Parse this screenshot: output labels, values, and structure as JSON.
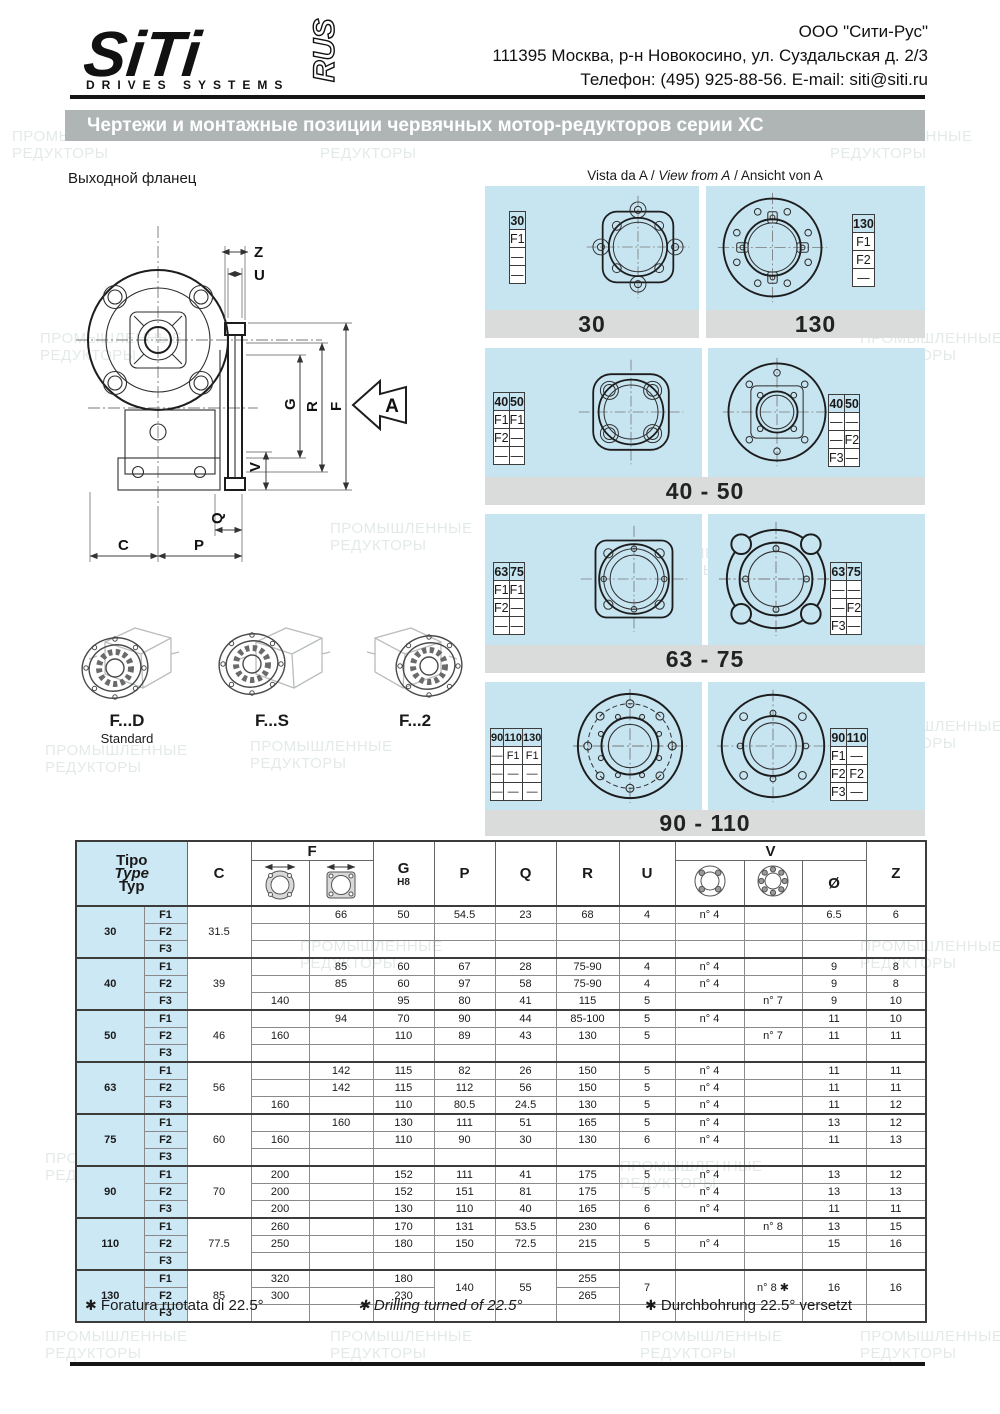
{
  "header": {
    "logo": {
      "main": "SiTi",
      "rus": "RUS",
      "subtitle": "DRIVES SYSTEMS"
    },
    "company": "ООО \"Сити-Рус\"",
    "address": "111395 Москва, р-н Новокосино, ул. Суздальская д. 2/3",
    "phone_email": "Телефон: (495) 925-88-56. E-mail: siti@siti.ru"
  },
  "title": "Чертежи и монтажные позиции червячных мотор-редукторов серии ХС",
  "drawing": {
    "label": "Выходной фланец",
    "dims": {
      "z": "Z",
      "u": "U",
      "g": "G",
      "r": "R",
      "f": "F",
      "v": "V",
      "q": "Q",
      "c": "C",
      "p": "P"
    },
    "view_arrow": "A",
    "variants": [
      {
        "code": "F...D",
        "note": "Standard"
      },
      {
        "code": "F...S",
        "note": ""
      },
      {
        "code": "F...2",
        "note": ""
      }
    ]
  },
  "vista": {
    "part1": "Vista da A /",
    "part2": "View from A",
    "part3": "/ Ansicht von A"
  },
  "panels": [
    {
      "caption": "30",
      "tables": [
        {
          "headers": [
            "30"
          ],
          "rows": [
            [
              "F1"
            ],
            [
              "—"
            ],
            [
              "—"
            ]
          ]
        }
      ]
    },
    {
      "caption": "130",
      "tables": [
        {
          "headers": [
            "130"
          ],
          "rows": [
            [
              "F1"
            ],
            [
              "F2"
            ],
            [
              "—"
            ]
          ]
        }
      ]
    },
    {
      "caption": "40 - 50",
      "tables": [
        {
          "headers": [
            "40",
            "50"
          ],
          "rows": [
            [
              "F1",
              "F1"
            ],
            [
              "F2",
              "—"
            ],
            [
              "—",
              "—"
            ]
          ]
        },
        {
          "headers": [
            "40",
            "50"
          ],
          "rows": [
            [
              "—",
              "—"
            ],
            [
              "—",
              "F2"
            ],
            [
              "F3",
              "—"
            ]
          ]
        }
      ]
    },
    {
      "caption": "63 - 75",
      "tables": [
        {
          "headers": [
            "63",
            "75"
          ],
          "rows": [
            [
              "F1",
              "F1"
            ],
            [
              "F2",
              "—"
            ],
            [
              "—",
              "—"
            ]
          ]
        },
        {
          "headers": [
            "63",
            "75"
          ],
          "rows": [
            [
              "—",
              "—"
            ],
            [
              "—",
              "F2"
            ],
            [
              "F3",
              "—"
            ]
          ]
        }
      ]
    },
    {
      "caption": "90 - 110",
      "tables": [
        {
          "headers": [
            "90",
            "110",
            "130"
          ],
          "rows": [
            [
              "—",
              "F1",
              "F1"
            ],
            [
              "—",
              "—",
              "—"
            ],
            [
              "—",
              "—",
              "—"
            ]
          ]
        },
        {
          "headers": [
            "90",
            "110"
          ],
          "rows": [
            [
              "F1",
              "—"
            ],
            [
              "F2",
              "F2"
            ],
            [
              "F3",
              "—"
            ]
          ]
        }
      ]
    }
  ],
  "table": {
    "cols": {
      "tipo1": "Tipo",
      "tipo2": "Type",
      "tipo3": "Typ",
      "c": "C",
      "f": "F",
      "g": "G",
      "g_tol": "H8",
      "p": "P",
      "q": "Q",
      "r": "R",
      "u": "U",
      "v": "V",
      "dia": "Ø",
      "z": "Z"
    },
    "flabels": [
      "F1",
      "F2",
      "F3"
    ],
    "groups": [
      {
        "size": "30",
        "c": "31.5",
        "rows": [
          [
            "",
            "66",
            "50",
            "54.5",
            "23",
            "68",
            "4",
            "n° 4",
            "",
            "6.5",
            "6"
          ],
          [
            "",
            "",
            "",
            "",
            "",
            "",
            "",
            "",
            "",
            "",
            ""
          ],
          [
            "",
            "",
            "",
            "",
            "",
            "",
            "",
            "",
            "",
            "",
            ""
          ]
        ]
      },
      {
        "size": "40",
        "c": "39",
        "rows": [
          [
            "",
            "85",
            "60",
            "67",
            "28",
            "75-90",
            "4",
            "n° 4",
            "",
            "9",
            "8"
          ],
          [
            "",
            "85",
            "60",
            "97",
            "58",
            "75-90",
            "4",
            "n° 4",
            "",
            "9",
            "8"
          ],
          [
            "140",
            "",
            "95",
            "80",
            "41",
            "115",
            "5",
            "",
            "n° 7",
            "9",
            "10"
          ]
        ]
      },
      {
        "size": "50",
        "c": "46",
        "rows": [
          [
            "",
            "94",
            "70",
            "90",
            "44",
            "85-100",
            "5",
            "n° 4",
            "",
            "11",
            "10"
          ],
          [
            "160",
            "",
            "110",
            "89",
            "43",
            "130",
            "5",
            "",
            "n° 7",
            "11",
            "11"
          ],
          [
            "",
            "",
            "",
            "",
            "",
            "",
            "",
            "",
            "",
            "",
            ""
          ]
        ]
      },
      {
        "size": "63",
        "c": "56",
        "rows": [
          [
            "",
            "142",
            "115",
            "82",
            "26",
            "150",
            "5",
            "n° 4",
            "",
            "11",
            "11"
          ],
          [
            "",
            "142",
            "115",
            "112",
            "56",
            "150",
            "5",
            "n° 4",
            "",
            "11",
            "11"
          ],
          [
            "160",
            "",
            "110",
            "80.5",
            "24.5",
            "130",
            "5",
            "n° 4",
            "",
            "11",
            "12"
          ]
        ]
      },
      {
        "size": "75",
        "c": "60",
        "rows": [
          [
            "",
            "160",
            "130",
            "111",
            "51",
            "165",
            "5",
            "n° 4",
            "",
            "13",
            "12"
          ],
          [
            "160",
            "",
            "110",
            "90",
            "30",
            "130",
            "6",
            "n° 4",
            "",
            "11",
            "13"
          ],
          [
            "",
            "",
            "",
            "",
            "",
            "",
            "",
            "",
            "",
            "",
            ""
          ]
        ]
      },
      {
        "size": "90",
        "c": "70",
        "rows": [
          [
            "200",
            "",
            "152",
            "111",
            "41",
            "175",
            "5",
            "n° 4",
            "",
            "13",
            "12"
          ],
          [
            "200",
            "",
            "152",
            "151",
            "81",
            "175",
            "5",
            "n° 4",
            "",
            "13",
            "13"
          ],
          [
            "200",
            "",
            "130",
            "110",
            "40",
            "165",
            "6",
            "n° 4",
            "",
            "11",
            "11"
          ]
        ]
      },
      {
        "size": "110",
        "c": "77.5",
        "rows": [
          [
            "260",
            "",
            "170",
            "131",
            "53.5",
            "230",
            "6",
            "",
            "n° 8",
            "13",
            "15"
          ],
          [
            "250",
            "",
            "180",
            "150",
            "72.5",
            "215",
            "5",
            "n° 4",
            "",
            "15",
            "16"
          ],
          [
            "",
            "",
            "",
            "",
            "",
            "",
            "",
            "",
            "",
            "",
            ""
          ]
        ]
      },
      {
        "size": "130",
        "c": "85",
        "rows": [
          [
            "320",
            "",
            "180",
            {
              "v": "140",
              "rs": 2
            },
            {
              "v": "55",
              "rs": 2
            },
            "255",
            {
              "v": "7",
              "rs": 2
            },
            {
              "v": "",
              "rs": 2
            },
            {
              "v": "n° 8 ✱",
              "rs": 2
            },
            {
              "v": "16",
              "rs": 2
            },
            {
              "v": "16",
              "rs": 2
            }
          ],
          [
            "300",
            "",
            "230",
            null,
            null,
            "265",
            null,
            null,
            null,
            null,
            null
          ],
          [
            "",
            "",
            "",
            "",
            "",
            "",
            "",
            "",
            "",
            "",
            ""
          ]
        ]
      }
    ]
  },
  "footnotes": [
    {
      "marker": "✱",
      "text": "Foratura ruotata di 22.5°",
      "style": "normal"
    },
    {
      "marker": "✱",
      "text": "Drilling turned of 22.5°",
      "style": "italic"
    },
    {
      "marker": "✱",
      "text": "Durchbohrung 22.5° versetzt",
      "style": "normal"
    }
  ],
  "watermark": {
    "line1": "ПРОМЫШЛЕННЫЕ",
    "line2": "РЕДУКТОРЫ"
  }
}
